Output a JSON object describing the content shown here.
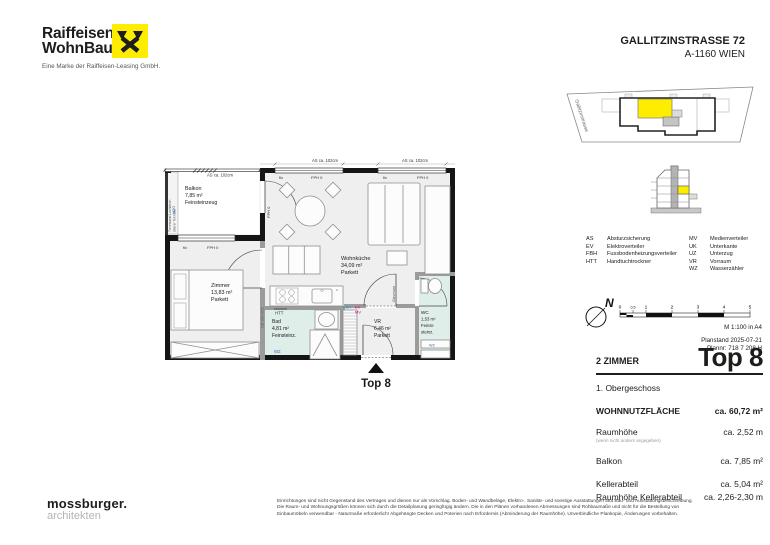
{
  "header": {
    "brand_line1": "Raiffeisen",
    "brand_line2": "WohnBau",
    "tagline": "Eine Marke der Raiffeisen-Leasing GmbH.",
    "address_line1": "GALLITZINSTRASSE 72",
    "address_line2": "A-1160 WIEN"
  },
  "site_plan": {
    "street_label": "Gallitzinstrasse"
  },
  "legend": {
    "col1": [
      {
        "abbr": "AS",
        "term": "Absturzsicherung"
      },
      {
        "abbr": "EV",
        "term": "Elektroverteiler"
      },
      {
        "abbr": "FBH",
        "term": "Fussbodenheizungsverteiler"
      },
      {
        "abbr": "HTT",
        "term": "Handtuchtrockner"
      }
    ],
    "col2": [
      {
        "abbr": "MV",
        "term": "Medienverteiler"
      },
      {
        "abbr": "UK",
        "term": "Unterkante"
      },
      {
        "abbr": "UZ",
        "term": "Unterzug"
      },
      {
        "abbr": "VR",
        "term": "Vorraum"
      },
      {
        "abbr": "WZ",
        "term": "Wasserzähler"
      }
    ]
  },
  "scale": {
    "north_label": "N",
    "ticks": [
      "0",
      "0,5",
      "1",
      "2",
      "3",
      "4",
      "5"
    ],
    "note": "M 1:100 in A4"
  },
  "plan_meta": {
    "planstand": "Planstand 2025-07-21",
    "plannr": "Plannr: 718 7 208 H"
  },
  "unit": {
    "rooms_count": "2 ZIMMER",
    "top_label": "Top 8",
    "floor_label": "1. Obergeschoss",
    "rows": [
      {
        "label": "WOHNNUTZFLÄCHE",
        "value": "ca. 60,72 m²"
      },
      {
        "label": "Raumhöhe",
        "sub": "(wenn nicht anders angegeben)",
        "value": "ca. 2,52 m"
      },
      {
        "label": "Balkon",
        "value": "ca. 7,85 m²"
      },
      {
        "label": "Kellerabteil",
        "value": "ca. 5,04 m²"
      },
      {
        "label": "Raumhöhe Kellerabteil",
        "value": "ca. 2,26-2,30 m"
      }
    ]
  },
  "floorplan": {
    "entrance_label": "Top 8",
    "rooms": [
      {
        "name": "Balkon",
        "area": "7,85 m²",
        "floor": "Feinsteinzeug"
      },
      {
        "name": "Wohnküche",
        "area": "34,09 m²",
        "floor": "Parkett"
      },
      {
        "name": "Zimmer",
        "area": "13,83 m²",
        "floor": "Parkett"
      },
      {
        "name": "Bad",
        "area": "4,81 m²",
        "floor": "Feinsteinz."
      },
      {
        "name": "VR",
        "area": "6,46 m²",
        "floor": "Parkett"
      },
      {
        "name": "WC",
        "area": "1,53 m²",
        "floor_line1": "Feinst-",
        "floor_line2": "steinz."
      }
    ],
    "annotations": {
      "as_dim": "AS ca. 102cm",
      "fix": "fix",
      "fph": "FPH 0",
      "uz": "UZ UK+222",
      "glas": "Glasersatz",
      "trennwand_line1": "Trennwand Lochblech",
      "trennwand_line2": "oberer Teil Glas",
      "h2o": "H2O",
      "htt": "HTT",
      "wz": "WZ",
      "fbh": "FBH",
      "ev": "EV",
      "mv": "MV",
      "asterisk": "*"
    }
  },
  "architect": {
    "name": "mossburger.",
    "suffix": "architekten"
  },
  "disclaimer": {
    "line1": "Einrichtungen sind nicht Gegenstand des Vertrages und dienen nur als Vorschlag. Boden- und Wandbeläge, Elektro-, Sanitär- und sonstige Ausstattungen laut Bau- und Ausstattungsbeschreibung.",
    "line2": "Die Raum- und Wohnungsgrößen können sich durch die Detailplanung geringfügig ändern. Die in den Plänen vorhandenen Abmessungen sind Rohbaumaße und nicht für die Bestellung von",
    "line3": "Einbaumöbeln verwendbar - Naturmaße erforderlich! Abgehängte Decken und Poterien nach Erfordernis (Abminderung der Raumhöhe). Unverbindliche Plankopie, Änderungen vorbehalten."
  },
  "colors": {
    "brand_yellow": "#ffed00",
    "highlight_yellow": "#ffed00",
    "wet_room_floor": "#e0eeea",
    "label_blue": "#2e6db4",
    "label_magenta": "#e5007d",
    "label_cyan": "#00a0d0"
  }
}
